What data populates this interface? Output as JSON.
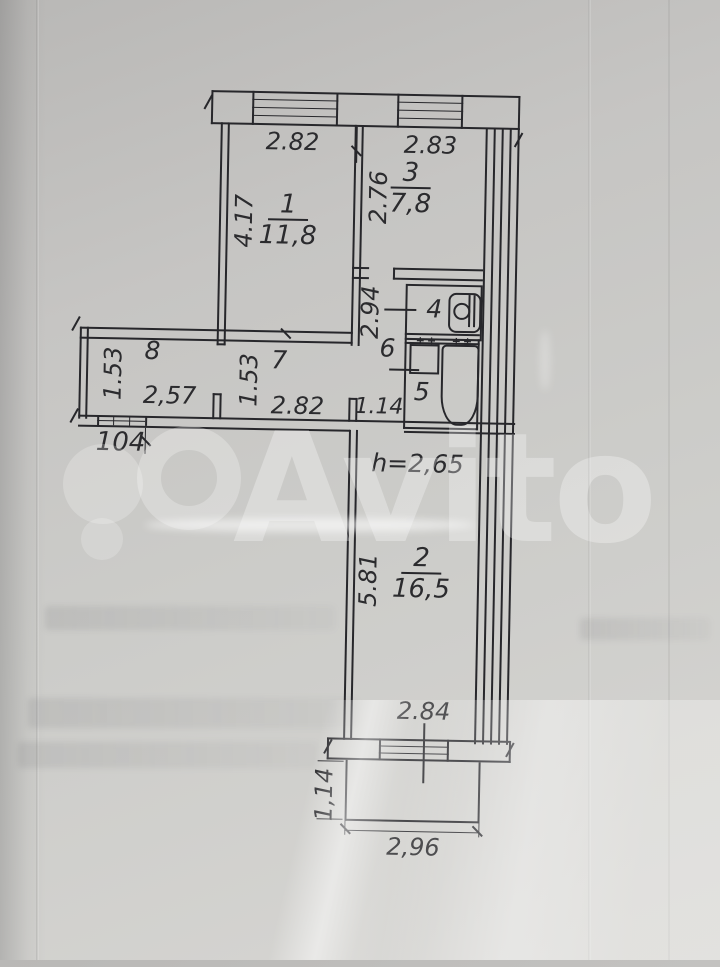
{
  "watermark": {
    "brand": "Avito"
  },
  "plan": {
    "apartment_number": "104",
    "ceiling_height_note": "h=2,65",
    "icons": {
      "faucet": "++"
    },
    "rooms": {
      "r1": {
        "number": "1",
        "area": "11,8"
      },
      "r2": {
        "number": "2",
        "area": "16,5"
      },
      "r3": {
        "number": "3",
        "area": "7,8"
      },
      "r4": {
        "number": "4"
      },
      "r5": {
        "number": "5"
      },
      "r6": {
        "number": "6"
      },
      "r7": {
        "number": "7"
      },
      "r8": {
        "number": "8"
      }
    },
    "dimensions": {
      "room1_width": "2.82",
      "room1_depth": "4.17",
      "room3_width": "2.83",
      "room3_depth": "2.76",
      "corridor_depth": "2.94",
      "corridor_width": "1.14",
      "room8_depth": "1.53",
      "room8_width": "2,57",
      "room7_depth": "1.53",
      "room7_width": "2.82",
      "room2_depth": "5.81",
      "room2_window_width": "2.84",
      "balcony_depth": "1,14",
      "balcony_width": "2,96"
    }
  }
}
